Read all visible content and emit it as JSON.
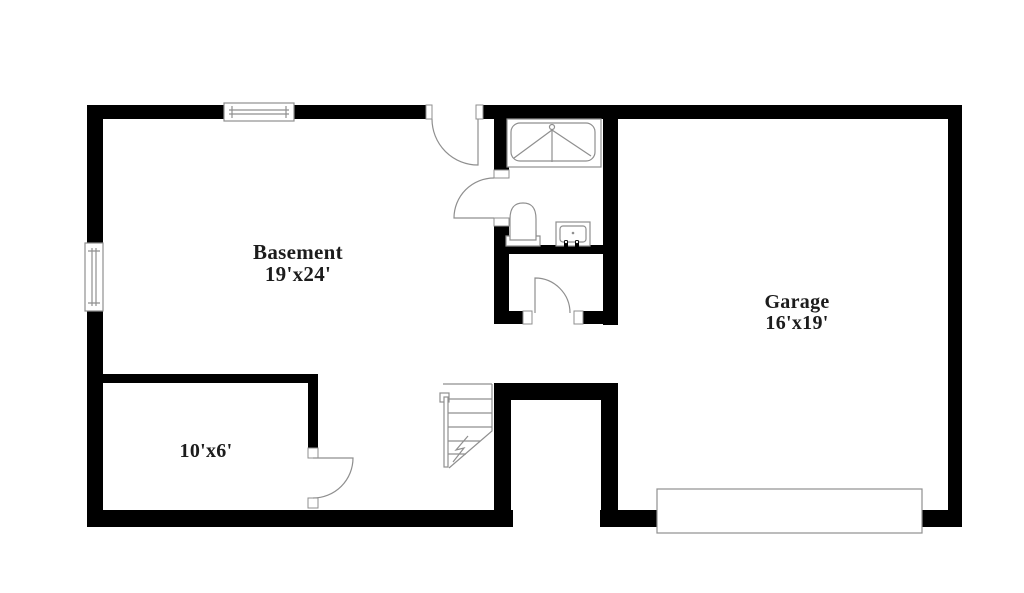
{
  "plan": {
    "type": "basement-floor-plan",
    "rooms": [
      {
        "name": "Basement",
        "dimensions": "19'x24'"
      },
      {
        "name": "Garage",
        "dimensions": "16'x19'"
      },
      {
        "dimensions": "10'x6'"
      }
    ],
    "fixtures": [
      "window-icon",
      "door-swing-icon",
      "bathtub-shower-icon",
      "toilet-icon",
      "sink-vanity-icon",
      "staircase-icon",
      "garage-door-icon"
    ],
    "colors": {
      "wall": "#000000",
      "fixture-line": "#8f8f8f",
      "text": "#1c1c1c",
      "background": "#ffffff"
    }
  }
}
